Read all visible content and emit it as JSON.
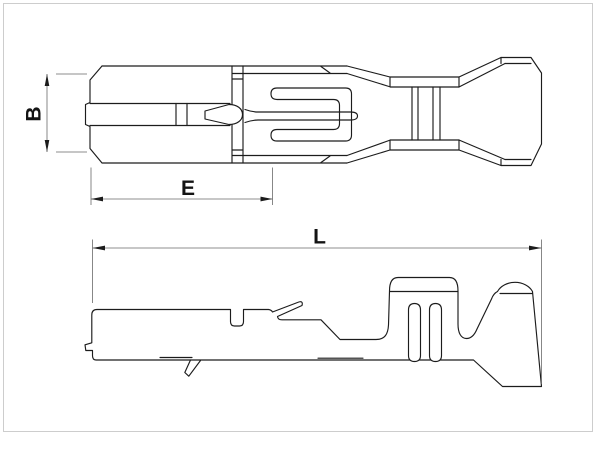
{
  "colors": {
    "part_line": "#1c1c1c",
    "dimension_line": "#6a6a6a",
    "label_text": "#141414",
    "frame": "#cdcdcd",
    "background": "#ffffff"
  },
  "drawing": {
    "description": "Engineering line drawing of a crimp terminal contact shown in top view and side view",
    "dimensions": {
      "B": "B",
      "E": "E",
      "L": "L"
    }
  }
}
